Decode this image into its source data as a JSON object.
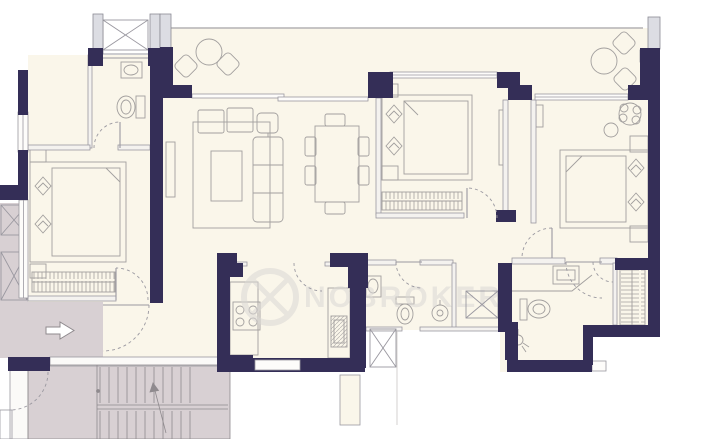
{
  "watermark": {
    "text": "NOBROKER",
    "logo_icon": "ring-logo"
  },
  "icons": {
    "entry": "entry-arrow",
    "stairs_direction": "up-arrow"
  },
  "colors": {
    "background": "#ffffff",
    "wall": "#342e57",
    "room_fill": "#faf6ea",
    "common_area_fill": "#d8d0d3",
    "pillar_fill": "#dcdde3",
    "furniture_line": "#a29f9e",
    "thin_wall_line": "#9a98a0",
    "stair_line": "#8f8a8e",
    "watermark": "#dbd8d6"
  }
}
